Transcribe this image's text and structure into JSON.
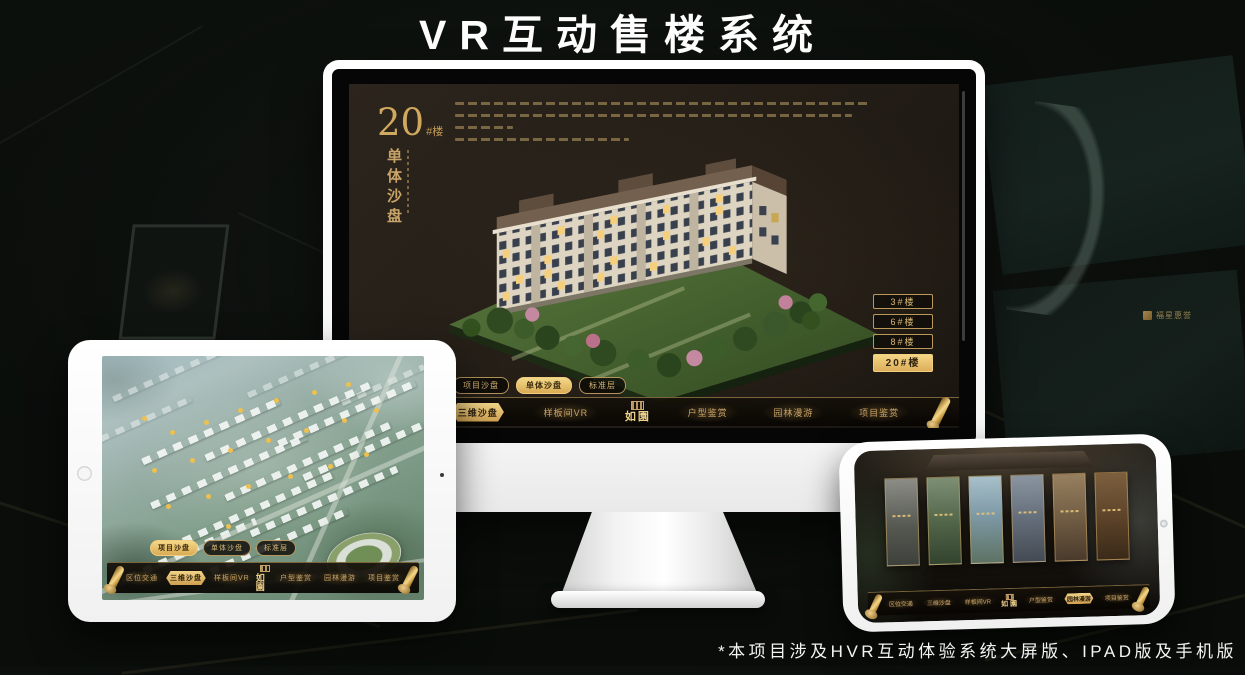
{
  "page": {
    "title": "VR互动售楼系统",
    "footnote": "*本项目涉及HVR互动体验系统大屏版、IPAD版及手机版"
  },
  "colors": {
    "gold": "#c9a468",
    "gold_bright": "#eed08a",
    "gold_deep": "#a87e3c",
    "page_bg": "#0b0e0b",
    "app_bg": "#28211a"
  },
  "brand": {
    "logo_text": "如園",
    "developer": "福星惠誉"
  },
  "nav": {
    "items": [
      {
        "label": "区位交通"
      },
      {
        "label": "三维沙盘"
      },
      {
        "label": "样板间VR"
      },
      {
        "label": "户型鉴赏"
      },
      {
        "label": "园林漫游"
      },
      {
        "label": "项目鉴赏"
      }
    ]
  },
  "monitor_app": {
    "headline_number": "20",
    "headline_suffix": "#楼",
    "headline_caption": "单体沙盘",
    "floor_buttons": [
      {
        "label": "3#楼",
        "active": false
      },
      {
        "label": "6#楼",
        "active": false
      },
      {
        "label": "8#楼",
        "active": false
      },
      {
        "label": "20#楼",
        "active": true
      }
    ],
    "sub_tabs": [
      {
        "label": "项目沙盘",
        "active": false
      },
      {
        "label": "单体沙盘",
        "active": true
      },
      {
        "label": "标准层",
        "active": false
      }
    ],
    "nav_active": "三维沙盘"
  },
  "ipad_app": {
    "sub_tabs": [
      {
        "label": "项目沙盘",
        "active": true
      },
      {
        "label": "单体沙盘",
        "active": false
      },
      {
        "label": "标准层",
        "active": false
      }
    ],
    "nav_active": "三维沙盘"
  },
  "phone_app": {
    "nav_active": "园林漫游",
    "gallery_count": 6
  }
}
